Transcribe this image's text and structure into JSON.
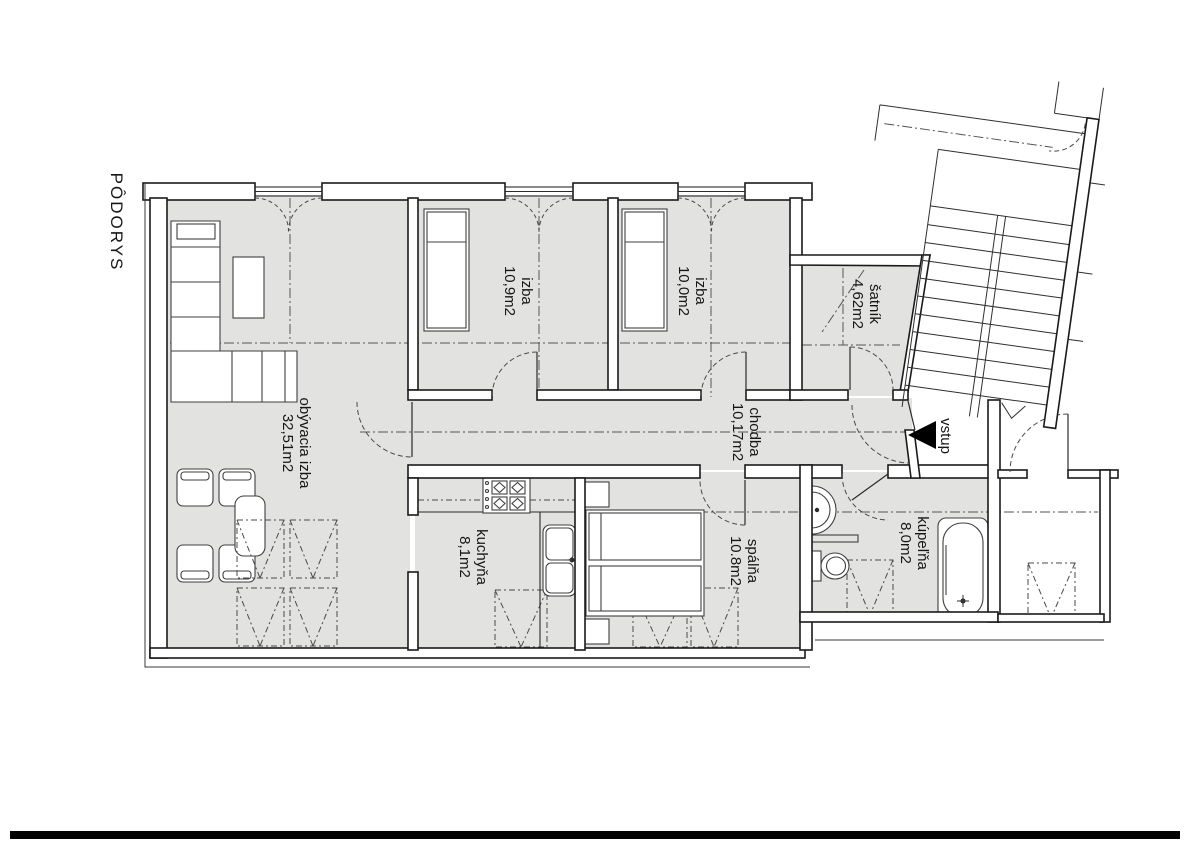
{
  "title": "PÔDORYS",
  "entrance": {
    "label": "vstup",
    "arrow_icon": "entry-arrow-left"
  },
  "rooms": {
    "living": {
      "name": "obývacia izba",
      "area": "32,51m2"
    },
    "room1": {
      "name": "izba",
      "area": "10,9m2"
    },
    "room2": {
      "name": "izba",
      "area": "10,0m2"
    },
    "closet": {
      "name": "šatník",
      "area": "4,62m2"
    },
    "hall": {
      "name": "chodba",
      "area": "10,17m2"
    },
    "kitchen": {
      "name": "kuchyňa",
      "area": "8,1m2"
    },
    "bedroom": {
      "name": "spálňa",
      "area": "10.8m2"
    },
    "bathroom": {
      "name": "kúpeľňa",
      "area": "8,0m2"
    }
  },
  "colors": {
    "room_fill": "#e2e2e1",
    "wall_fill": "#ffffff",
    "line": "#1a1a1a",
    "footer_bar": "#000000"
  }
}
